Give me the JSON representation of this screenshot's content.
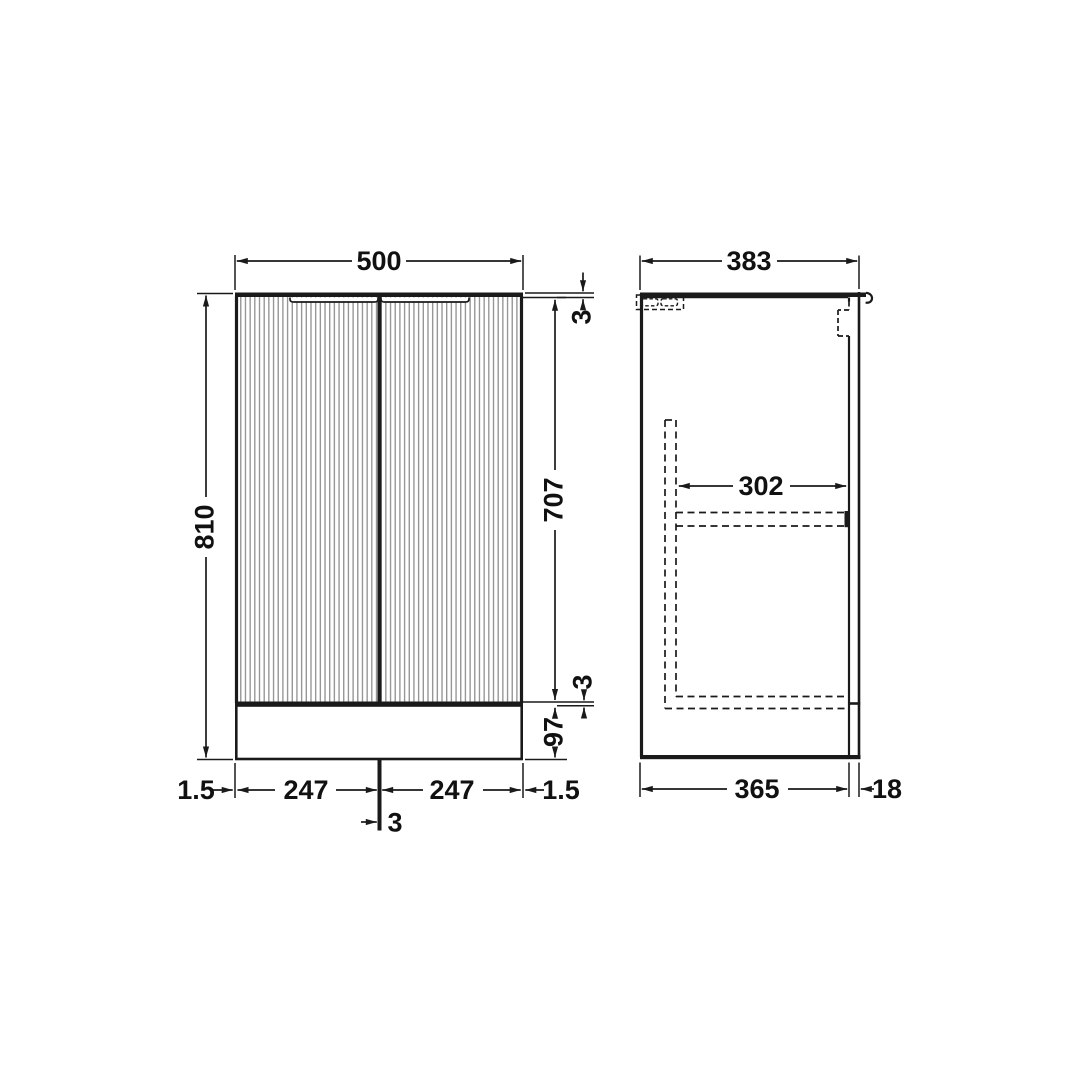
{
  "drawing": {
    "type": "bathroom-vanity-unit-technical-drawing",
    "colors": {
      "line": "#1a1a1a",
      "flute": "#8f8f8f",
      "background": "#ffffff"
    },
    "front_view": {
      "overall_width": "500",
      "overall_height": "810",
      "worktop_thickness": "3",
      "door_height": "707",
      "door_bottom_gap": "3",
      "plinth_height": "97",
      "left_edge_gap": "1.5",
      "left_door_width": "247",
      "centre_gap": "3",
      "right_door_width": "247",
      "right_edge_gap": "1.5"
    },
    "side_view": {
      "overall_depth": "383",
      "internal_shelf_depth": "302",
      "carcass_depth": "365",
      "door_thickness": "18"
    }
  }
}
